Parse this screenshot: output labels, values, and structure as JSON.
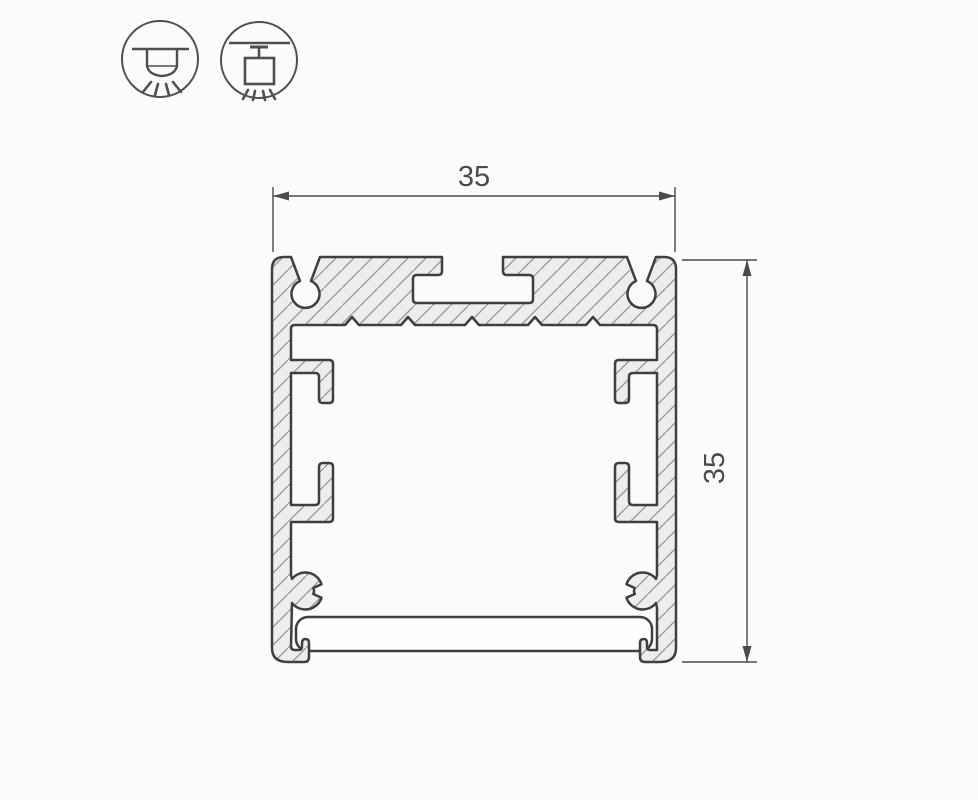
{
  "drawing": {
    "type": "technical-cross-section",
    "subject": "aluminum-led-profile",
    "dimensions": {
      "width_label": "35",
      "height_label": "35"
    },
    "icons": [
      {
        "name": "surface-mount-light-icon",
        "meaning": "surface ceiling mount, light directed down"
      },
      {
        "name": "pendant-mount-light-icon",
        "meaning": "suspended pendant mount, light directed down"
      }
    ],
    "colors": {
      "background": "#fbfbfb",
      "outline": "#3f3f3f",
      "material_fill": "#ededed",
      "hatch_line": "#9b9b9b",
      "dimension_line": "#4a4a4a",
      "icon_stroke": "#4f4f4f",
      "diffuser_fill": "#fdfdfd"
    }
  }
}
